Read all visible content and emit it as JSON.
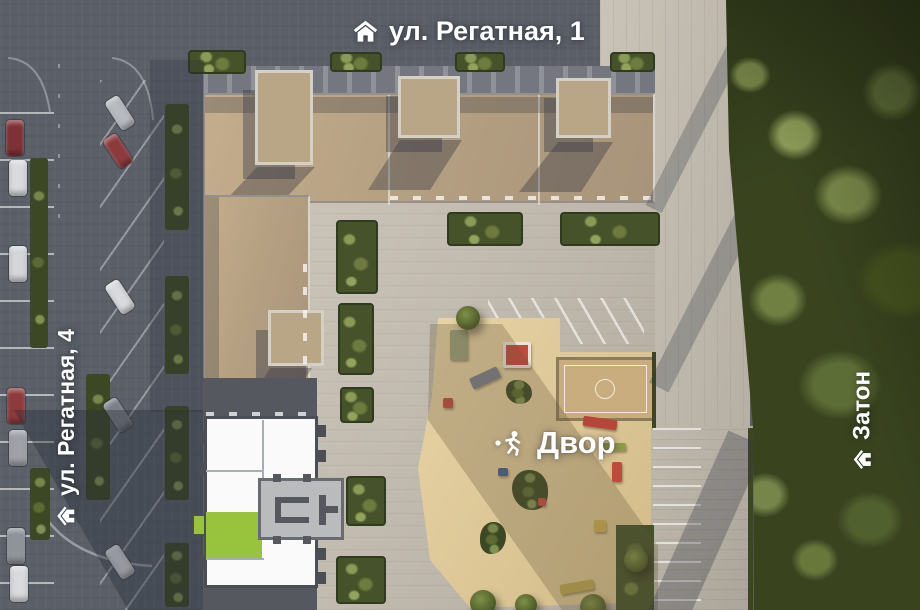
{
  "labels": {
    "street_top": "ул. Регатная, 1",
    "street_left": "ул. Регатная, 4",
    "area_right": "Затон",
    "courtyard": "Двор"
  },
  "icons": {
    "street_top": "house-icon",
    "street_left": "house-icon",
    "area_right": "house-icon",
    "courtyard": "playground-figure-icon"
  },
  "selection": {
    "selected_unit_color": "#97c43c"
  },
  "colors": {
    "road": "#5a5f68",
    "paving": "#c2bbaf",
    "roof": "#b5a082",
    "facade": "#74777f",
    "sand": "#e0cb9c",
    "court": "#c9ad7e",
    "forest": "#39441f",
    "hedge": "#46522a",
    "plan_wall": "#4b4e54",
    "plan_floor": "#fafafa",
    "plan_core": "#babbbd",
    "selected_green": "#97c43c",
    "label": "#ffffff"
  }
}
